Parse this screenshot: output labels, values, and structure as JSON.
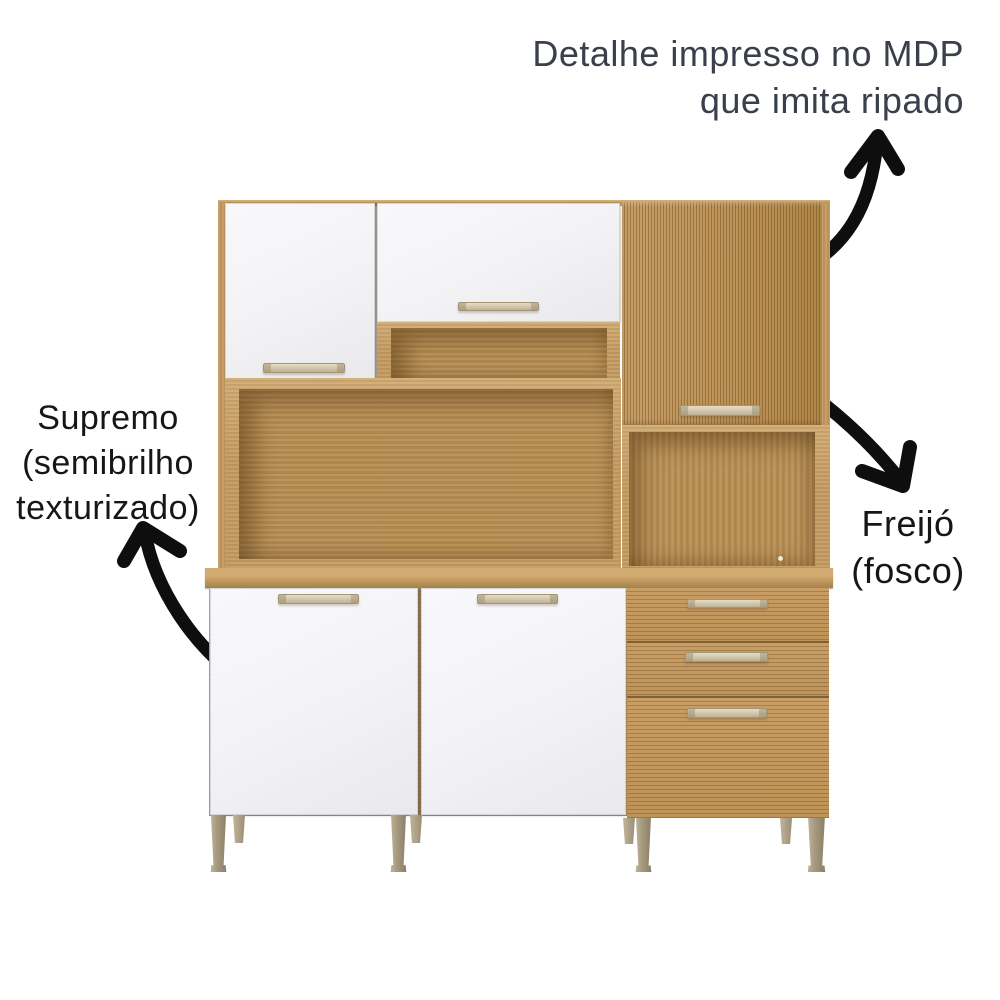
{
  "annotations": {
    "ripado": {
      "lines": [
        "Detalhe impresso no MDP",
        "que imita ripado"
      ]
    },
    "supremo": {
      "lines": [
        "Supremo",
        "(semibrilho",
        "texturizado)"
      ]
    },
    "freijo": {
      "lines": [
        "Freijó",
        "(fosco)"
      ]
    }
  },
  "icons": {
    "arrow_to_ripado_label": "curved-arrow-up",
    "arrow_to_freijo_label": "curved-arrow-down-right",
    "arrow_to_supremo_label": "curved-arrow-up-left"
  },
  "colors": {
    "background": "#ffffff",
    "text_dark": "#3a3f4c",
    "text_black": "#161616",
    "arrow": "#0e0e0e",
    "wood": "#c49a61",
    "wood_light": "#d2ab72",
    "wood_dark": "#a5824c",
    "wood_interior": "#b98e53",
    "wood_interior_dark": "#8a6637",
    "door_white": "#f4f4f6",
    "door_white_shade": "#e9e9ec",
    "handle_light": "#e6ddc7",
    "handle_dark": "#bfb194",
    "leg_light": "#c0b49a",
    "leg_dark": "#8a7d64"
  }
}
